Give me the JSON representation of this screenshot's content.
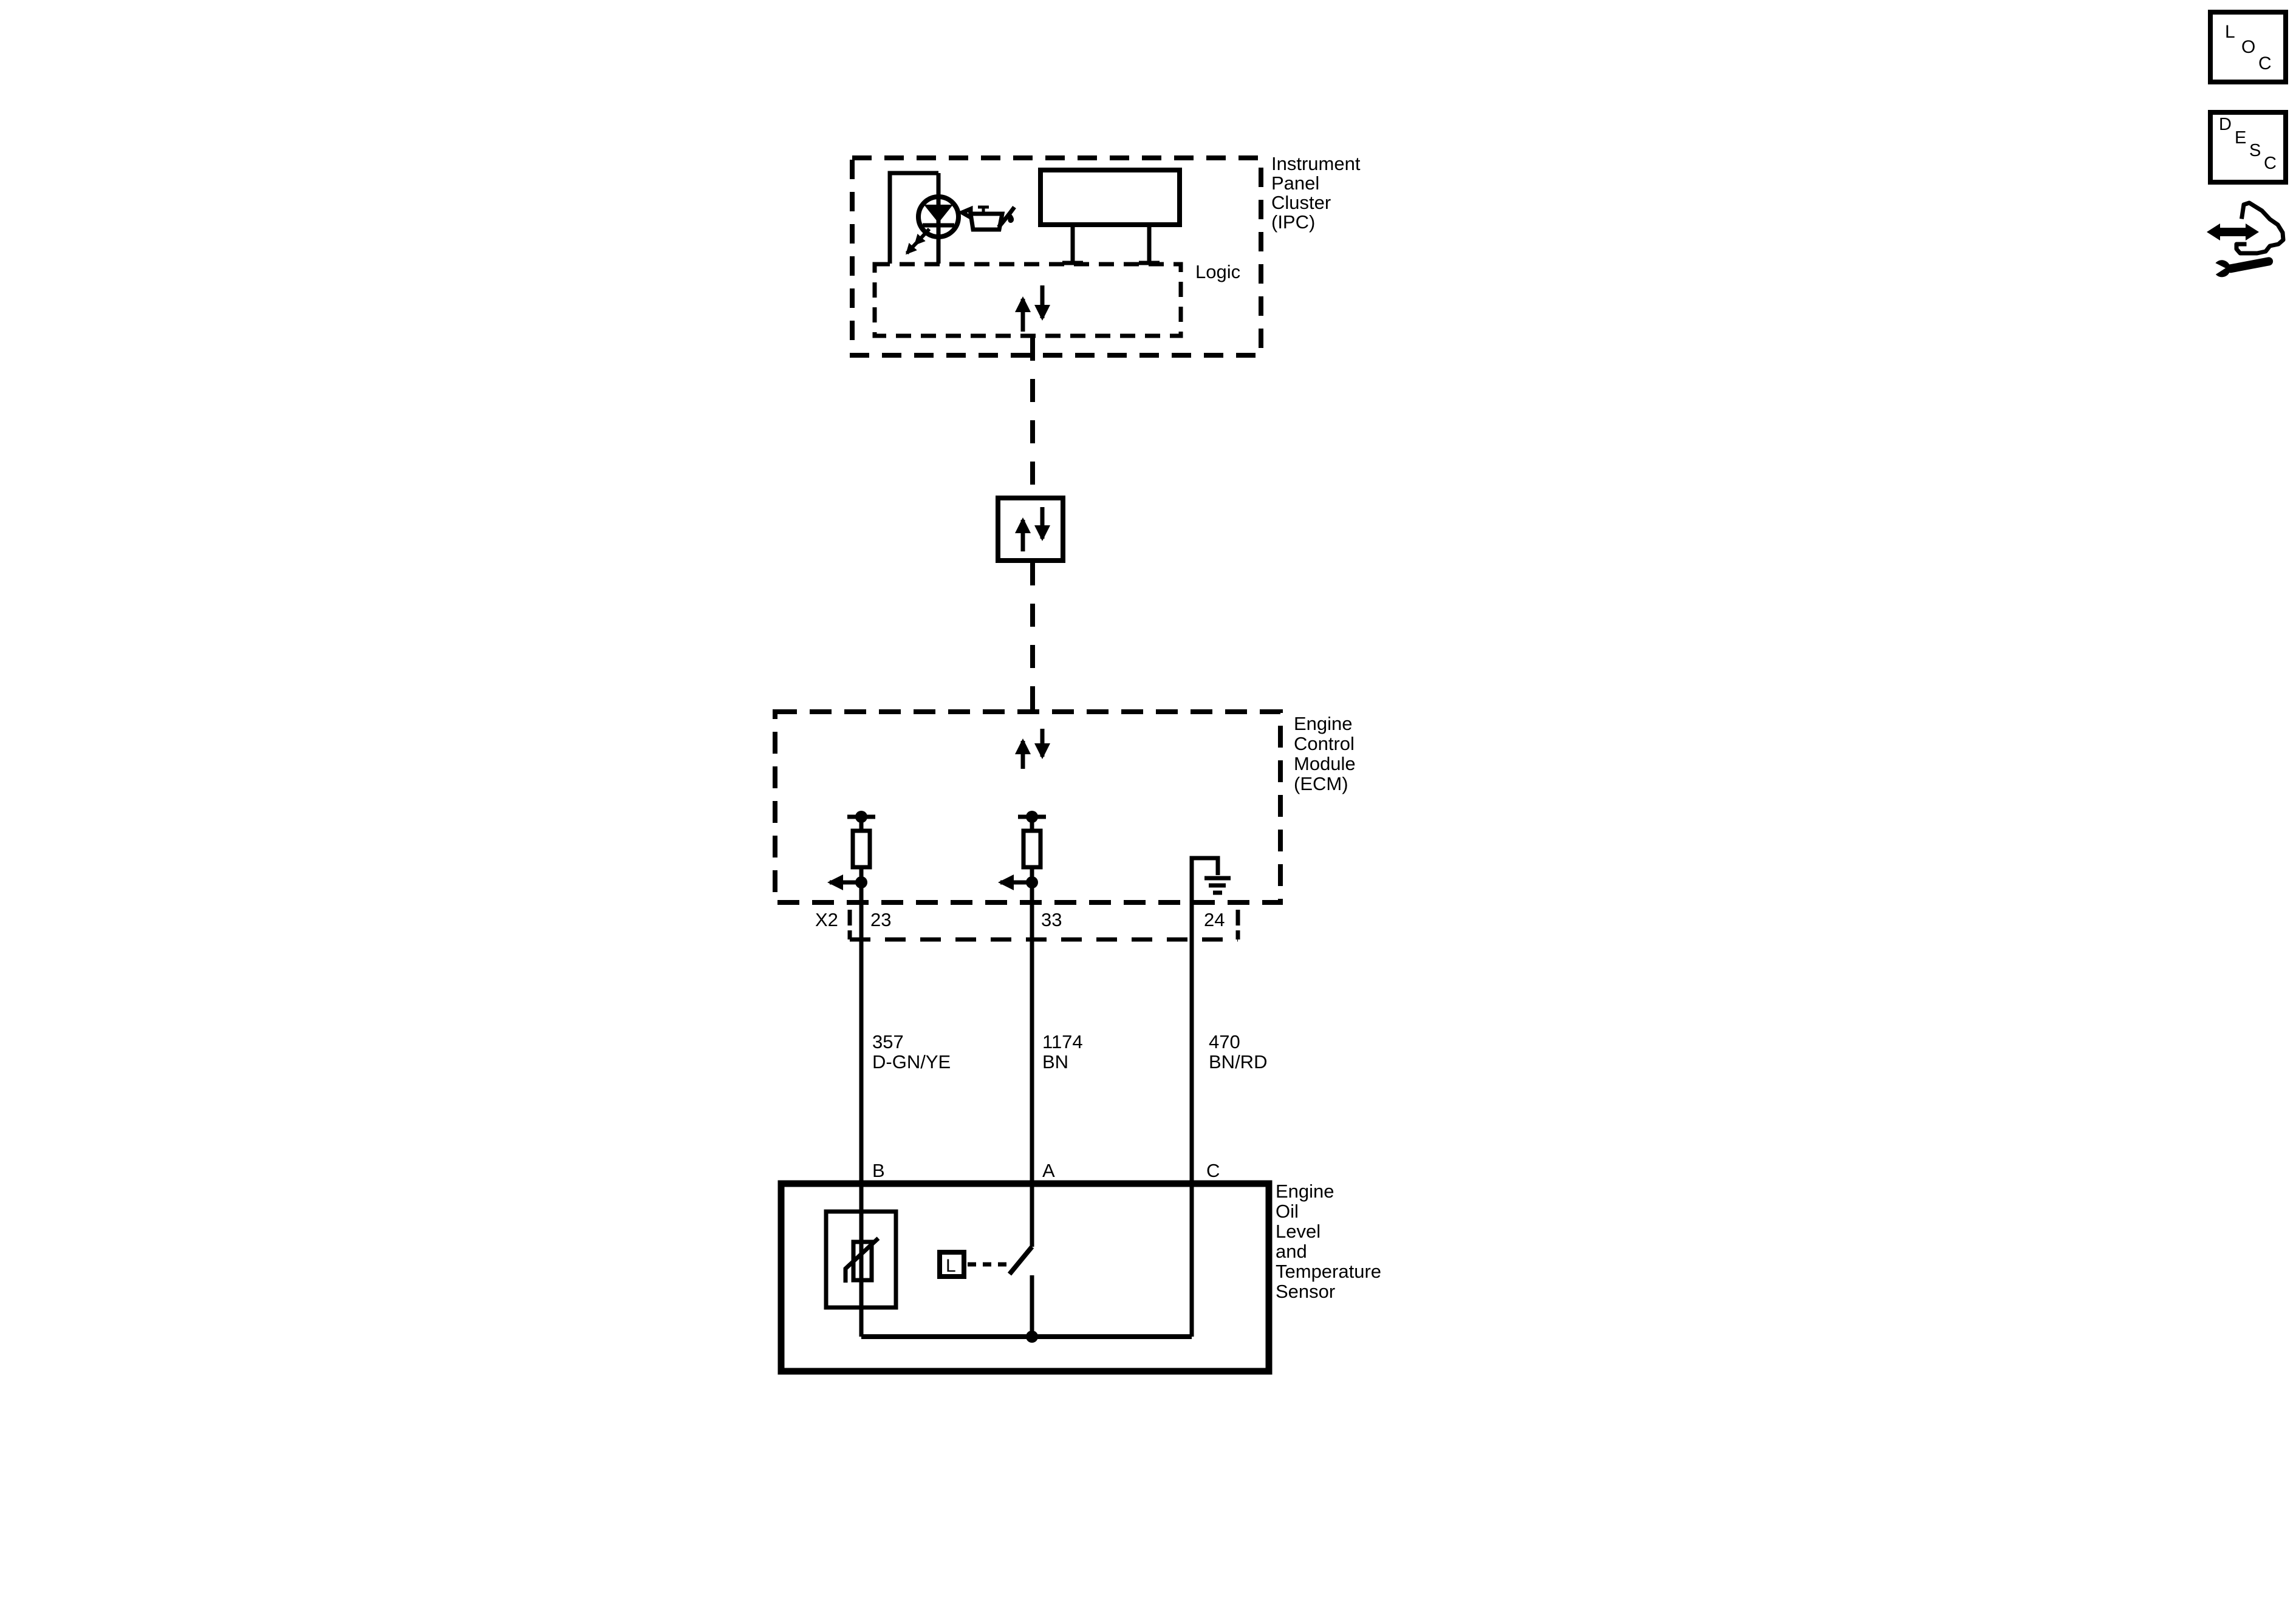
{
  "ipc": {
    "title_lines": [
      "Instrument",
      "Panel",
      "Cluster",
      "(IPC)"
    ],
    "logic_label": "Logic"
  },
  "ecm": {
    "title_lines": [
      "Engine",
      "Control",
      "Module",
      "(ECM)"
    ],
    "connector_label": "X2",
    "pin_labels": [
      "23",
      "33",
      "24"
    ]
  },
  "wires": [
    {
      "circuit_number": "357",
      "wire_color": "D-GN/YE"
    },
    {
      "circuit_number": "1174",
      "wire_color": "BN"
    },
    {
      "circuit_number": "470",
      "wire_color": "BN/RD"
    }
  ],
  "sensor": {
    "title_lines": [
      "Engine",
      "Oil",
      "Level",
      "and",
      "Temperature",
      "Sensor"
    ],
    "terminal_labels": [
      "B",
      "A",
      "C"
    ],
    "level_switch_label": "L"
  },
  "toolbar_icons": {
    "loc_letters": [
      "L",
      "O",
      "C"
    ],
    "desc_letters": [
      "D",
      "E",
      "S",
      "C"
    ]
  },
  "colors": {
    "ink": "#000000",
    "background": "#ffffff"
  }
}
